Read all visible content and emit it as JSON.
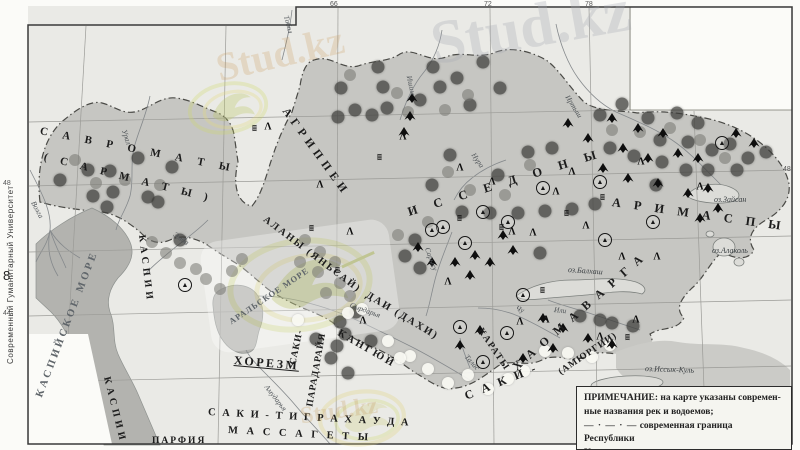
{
  "page": {
    "margin_text": "Современный Гуманитарный Университет",
    "page_number": "8"
  },
  "colors": {
    "paper": "#eaeae6",
    "land": "#c6c6c2",
    "land-se": "#cbcbc7",
    "sea": "#b3b3af",
    "lake": "#dcdcd8",
    "frame": "#3a3a3a",
    "gridline": "#9b9b97",
    "riverline": "#85898c",
    "border-dash": "#4a4a46"
  },
  "legend": {
    "title": "ПРИМЕЧАНИЕ:",
    "line1": "на карте указаны современ-",
    "line2": "ные названия рек и водоемов;",
    "border_symbol": "— · — · —",
    "border_line1": "современная граница Республики",
    "border_line2": "Казахстан"
  },
  "watermark": {
    "ghost_text": "Stud.kz"
  },
  "map": {
    "labels": [
      {
        "t": "С А В Р О М А Т Ы",
        "x": 40,
        "y": 126,
        "r": 11,
        "fs": 11,
        "ls": 6,
        "c": "tribe"
      },
      {
        "t": "( С А Р М А Т Ы )",
        "x": 44,
        "y": 152,
        "r": 14,
        "fs": 11,
        "ls": 5,
        "c": "tribe"
      },
      {
        "t": "АГРИППЕИ",
        "x": 284,
        "y": 104,
        "r": 54,
        "fs": 11.5,
        "ls": 5,
        "c": "tribe"
      },
      {
        "t": "И С С Е Д О Н Ы",
        "x": 408,
        "y": 206,
        "r": -17,
        "fs": 12.5,
        "ls": 7,
        "c": "tribe"
      },
      {
        "t": "А Р И М А С П Ы",
        "x": 612,
        "y": 196,
        "r": 8,
        "fs": 12.5,
        "ls": 5,
        "c": "tribe"
      },
      {
        "t": "АЛАНЫ (ЯНЬСАЙ)",
        "x": 264,
        "y": 214,
        "r": 37,
        "fs": 10,
        "ls": 2,
        "c": "tribe"
      },
      {
        "t": "КАСПИИ",
        "x": 141,
        "y": 230,
        "r": 83,
        "fs": 10,
        "ls": 4,
        "c": "tribe"
      },
      {
        "t": "КАСПИИ",
        "x": 106,
        "y": 372,
        "r": 76,
        "fs": 10,
        "ls": 4,
        "c": "tribe"
      },
      {
        "t": "ДАИ (ДАХИ)",
        "x": 366,
        "y": 290,
        "r": 31,
        "fs": 10.5,
        "ls": 2,
        "c": "tribe"
      },
      {
        "t": "КАНГЮЙ",
        "x": 338,
        "y": 328,
        "r": 30,
        "fs": 10.5,
        "ls": 2.5,
        "c": "tribe"
      },
      {
        "t": "САКИ-",
        "x": 294,
        "y": 360,
        "r": -78,
        "fs": 9.5,
        "ls": 1,
        "c": "tribe"
      },
      {
        "t": "ПАРАДАРАЙЯ",
        "x": 311,
        "y": 402,
        "r": -80,
        "fs": 9.5,
        "ls": 1,
        "c": "tribe"
      },
      {
        "t": "ХОРЕЗМ",
        "x": 234,
        "y": 354,
        "r": 5,
        "fs": 12,
        "ls": 2.5,
        "c": "tribe u"
      },
      {
        "t": "С А К И -",
        "x": 465,
        "y": 390,
        "r": -22,
        "fs": 12,
        "ls": 3,
        "c": "tribe"
      },
      {
        "t": "Х А О М А В А Р Г А",
        "x": 514,
        "y": 362,
        "r": -41,
        "fs": 12,
        "ls": 3,
        "c": "tribe"
      },
      {
        "t": "(АМЮРГИИ)",
        "x": 560,
        "y": 369,
        "r": -34,
        "fs": 9.5,
        "ls": 1,
        "c": "tribe"
      },
      {
        "t": "КАРАТЫ",
        "x": 479,
        "y": 325,
        "r": 56,
        "fs": 9.5,
        "ls": 1.5,
        "c": "tribe"
      },
      {
        "t": "С А К И - Т И Г Р А Х А У Д А",
        "x": 208,
        "y": 408,
        "r": 3,
        "fs": 10.5,
        "ls": 2,
        "c": "tribe"
      },
      {
        "t": "М А С С А Г Е Т Ы",
        "x": 228,
        "y": 426,
        "r": 3,
        "fs": 10.5,
        "ls": 3,
        "c": "tribe"
      },
      {
        "t": "ПАРФИЯ",
        "x": 152,
        "y": 437,
        "r": 0,
        "fs": 9.5,
        "ls": 2,
        "c": "tribe"
      },
      {
        "t": "КАСПИЙСКОЕ МОРЕ",
        "x": 40,
        "y": 392,
        "r": -69,
        "fs": 10.5,
        "ls": 3,
        "c": "sea"
      },
      {
        "t": "АРАЛЬСКОЕ МОРЕ",
        "x": 230,
        "y": 318,
        "r": -34,
        "fs": 8.5,
        "ls": 1,
        "c": "sea"
      },
      {
        "t": "Волга",
        "x": 33,
        "y": 198,
        "r": 62,
        "fs": 7.5,
        "ls": 0,
        "c": "river"
      },
      {
        "t": "Урал",
        "x": 124,
        "y": 126,
        "r": 72,
        "fs": 7.5,
        "ls": 0,
        "c": "river"
      },
      {
        "t": "Эмба",
        "x": 174,
        "y": 230,
        "r": 35,
        "fs": 7.5,
        "ls": 0,
        "c": "river"
      },
      {
        "t": "Тобол",
        "x": 286,
        "y": 12,
        "r": 75,
        "fs": 7.5,
        "ls": 0,
        "c": "river"
      },
      {
        "t": "Ишим",
        "x": 409,
        "y": 72,
        "r": 78,
        "fs": 7.5,
        "ls": 0,
        "c": "river"
      },
      {
        "t": "Иртыш",
        "x": 567,
        "y": 92,
        "r": 58,
        "fs": 7.5,
        "ls": 0,
        "c": "river"
      },
      {
        "t": "Нура",
        "x": 473,
        "y": 150,
        "r": 55,
        "fs": 7.5,
        "ls": 0,
        "c": "river"
      },
      {
        "t": "Сарысу",
        "x": 427,
        "y": 244,
        "r": 70,
        "fs": 7.5,
        "ls": 0,
        "c": "river"
      },
      {
        "t": "Сырдарья",
        "x": 350,
        "y": 301,
        "r": 20,
        "fs": 7.5,
        "ls": 0,
        "c": "river"
      },
      {
        "t": "Амударья",
        "x": 266,
        "y": 382,
        "r": 52,
        "fs": 7.5,
        "ls": 0,
        "c": "river"
      },
      {
        "t": "Чу",
        "x": 516,
        "y": 304,
        "r": 22,
        "fs": 7.5,
        "ls": 0,
        "c": "river"
      },
      {
        "t": "Или",
        "x": 554,
        "y": 306,
        "r": 6,
        "fs": 7.5,
        "ls": 0,
        "c": "river"
      },
      {
        "t": "Талас",
        "x": 466,
        "y": 352,
        "r": 48,
        "fs": 7.5,
        "ls": 0,
        "c": "river"
      },
      {
        "t": "оз.Балхаш",
        "x": 568,
        "y": 266,
        "r": 4,
        "fs": 8,
        "ls": 0,
        "c": "lake"
      },
      {
        "t": "оз.Зайсан",
        "x": 714,
        "y": 196,
        "r": 0,
        "fs": 8,
        "ls": 0,
        "c": "lake"
      },
      {
        "t": "оз.Алаколь",
        "x": 712,
        "y": 247,
        "r": 0,
        "fs": 8,
        "ls": 0,
        "c": "lake"
      },
      {
        "t": "оз.Иссык-Куль",
        "x": 645,
        "y": 365,
        "r": 2,
        "fs": 8,
        "ls": 0,
        "c": "lake"
      },
      {
        "t": "66",
        "x": 330,
        "y": 1,
        "r": 0,
        "fs": 7,
        "ls": 0,
        "c": "grid"
      },
      {
        "t": "72",
        "x": 484,
        "y": 1,
        "r": 0,
        "fs": 7,
        "ls": 0,
        "c": "grid"
      },
      {
        "t": "78",
        "x": 585,
        "y": 1,
        "r": 0,
        "fs": 7,
        "ls": 0,
        "c": "grid"
      },
      {
        "t": "48",
        "x": 3,
        "y": 180,
        "r": 0,
        "fs": 7,
        "ls": 0,
        "c": "grid"
      },
      {
        "t": "44",
        "x": 3,
        "y": 310,
        "r": 0,
        "fs": 7,
        "ls": 0,
        "c": "grid"
      },
      {
        "t": "48",
        "x": 783,
        "y": 166,
        "r": 0,
        "fs": 7,
        "ls": 0,
        "c": "grid"
      }
    ],
    "symbols": {
      "dark": [
        [
          60,
          180
        ],
        [
          88,
          170
        ],
        [
          110,
          171
        ],
        [
          113,
          192
        ],
        [
          138,
          158
        ],
        [
          172,
          167
        ],
        [
          93,
          196
        ],
        [
          107,
          207
        ],
        [
          148,
          197
        ],
        [
          158,
          202
        ],
        [
          180,
          240
        ],
        [
          341,
          88
        ],
        [
          378,
          67
        ],
        [
          383,
          87
        ],
        [
          433,
          67
        ],
        [
          440,
          87
        ],
        [
          355,
          110
        ],
        [
          338,
          117
        ],
        [
          372,
          115
        ],
        [
          387,
          108
        ],
        [
          420,
          100
        ],
        [
          457,
          78
        ],
        [
          483,
          62
        ],
        [
          500,
          88
        ],
        [
          470,
          105
        ],
        [
          600,
          115
        ],
        [
          622,
          104
        ],
        [
          648,
          118
        ],
        [
          677,
          113
        ],
        [
          698,
          123
        ],
        [
          660,
          140
        ],
        [
          688,
          142
        ],
        [
          712,
          150
        ],
        [
          730,
          144
        ],
        [
          748,
          158
        ],
        [
          662,
          162
        ],
        [
          634,
          156
        ],
        [
          610,
          148
        ],
        [
          686,
          170
        ],
        [
          708,
          170
        ],
        [
          656,
          185
        ],
        [
          766,
          152
        ],
        [
          737,
          170
        ],
        [
          498,
          175
        ],
        [
          528,
          152
        ],
        [
          552,
          148
        ],
        [
          450,
          155
        ],
        [
          432,
          185
        ],
        [
          462,
          212
        ],
        [
          490,
          213
        ],
        [
          518,
          213
        ],
        [
          545,
          211
        ],
        [
          572,
          209
        ],
        [
          595,
          204
        ],
        [
          415,
          240
        ],
        [
          405,
          256
        ],
        [
          420,
          268
        ],
        [
          340,
          322
        ],
        [
          345,
          334
        ],
        [
          337,
          346
        ],
        [
          316,
          339
        ],
        [
          331,
          358
        ],
        [
          356,
          312
        ],
        [
          371,
          341
        ],
        [
          348,
          373
        ],
        [
          540,
          253
        ],
        [
          612,
          323
        ],
        [
          633,
          326
        ],
        [
          580,
          316
        ],
        [
          600,
          320
        ]
      ],
      "mid": [
        [
          75,
          160
        ],
        [
          125,
          180
        ],
        [
          160,
          185
        ],
        [
          96,
          183
        ],
        [
          350,
          75
        ],
        [
          397,
          93
        ],
        [
          408,
          112
        ],
        [
          445,
          110
        ],
        [
          468,
          95
        ],
        [
          612,
          130
        ],
        [
          640,
          132
        ],
        [
          670,
          128
        ],
        [
          700,
          140
        ],
        [
          725,
          158
        ],
        [
          530,
          165
        ],
        [
          505,
          195
        ],
        [
          470,
          190
        ],
        [
          448,
          172
        ],
        [
          305,
          240
        ],
        [
          320,
          252
        ],
        [
          335,
          262
        ],
        [
          318,
          272
        ],
        [
          300,
          262
        ],
        [
          340,
          283
        ],
        [
          326,
          293
        ],
        [
          350,
          296
        ],
        [
          152,
          242
        ],
        [
          166,
          253
        ],
        [
          180,
          263
        ],
        [
          196,
          269
        ],
        [
          206,
          279
        ],
        [
          220,
          289
        ],
        [
          232,
          271
        ],
        [
          242,
          259
        ],
        [
          428,
          222
        ],
        [
          398,
          235
        ]
      ],
      "light": [
        [
          348,
          313
        ],
        [
          362,
          309
        ],
        [
          410,
          356
        ],
        [
          428,
          369
        ],
        [
          448,
          383
        ],
        [
          468,
          375
        ],
        [
          488,
          389
        ],
        [
          508,
          379
        ],
        [
          524,
          371
        ],
        [
          545,
          351
        ],
        [
          568,
          353
        ],
        [
          592,
          357
        ],
        [
          610,
          345
        ],
        [
          388,
          341
        ],
        [
          400,
          358
        ],
        [
          298,
          320
        ]
      ],
      "peak": [
        [
          612,
          118
        ],
        [
          638,
          128
        ],
        [
          663,
          133
        ],
        [
          623,
          148
        ],
        [
          648,
          158
        ],
        [
          678,
          153
        ],
        [
          698,
          158
        ],
        [
          603,
          168
        ],
        [
          628,
          178
        ],
        [
          658,
          183
        ],
        [
          688,
          193
        ],
        [
          708,
          188
        ],
        [
          568,
          123
        ],
        [
          588,
          138
        ],
        [
          736,
          133
        ],
        [
          754,
          143
        ],
        [
          412,
          98
        ],
        [
          410,
          116
        ],
        [
          404,
          132
        ],
        [
          503,
          235
        ],
        [
          513,
          250
        ],
        [
          490,
          262
        ],
        [
          475,
          255
        ],
        [
          455,
          262
        ],
        [
          470,
          275
        ],
        [
          418,
          247
        ],
        [
          432,
          262
        ],
        [
          543,
          318
        ],
        [
          563,
          328
        ],
        [
          588,
          338
        ],
        [
          612,
          344
        ],
        [
          553,
          348
        ],
        [
          523,
          358
        ],
        [
          480,
          330
        ],
        [
          460,
          345
        ],
        [
          718,
          208
        ],
        [
          700,
          218
        ]
      ],
      "ct": [
        [
          185,
          285
        ],
        [
          443,
          227
        ],
        [
          465,
          243
        ],
        [
          460,
          327
        ],
        [
          483,
          362
        ],
        [
          507,
          333
        ],
        [
          523,
          295
        ],
        [
          543,
          188
        ],
        [
          432,
          230
        ],
        [
          508,
          222
        ],
        [
          600,
          182
        ],
        [
          653,
          222
        ],
        [
          605,
          240
        ],
        [
          722,
          143
        ],
        [
          483,
          212
        ]
      ],
      "lam": [
        [
          320,
          185
        ],
        [
          403,
          137
        ],
        [
          350,
          232
        ],
        [
          363,
          321
        ],
        [
          460,
          168
        ],
        [
          492,
          182
        ],
        [
          512,
          232
        ],
        [
          533,
          233
        ],
        [
          556,
          192
        ],
        [
          572,
          172
        ],
        [
          586,
          226
        ],
        [
          622,
          257
        ],
        [
          641,
          162
        ],
        [
          657,
          257
        ],
        [
          700,
          187
        ],
        [
          520,
          322
        ],
        [
          546,
          320
        ],
        [
          600,
          337
        ],
        [
          636,
          320
        ],
        [
          268,
          127
        ],
        [
          448,
          282
        ]
      ],
      "sh": [
        [
          255,
          128
        ],
        [
          380,
          157
        ],
        [
          502,
          227
        ],
        [
          567,
          213
        ],
        [
          603,
          197
        ],
        [
          460,
          218
        ],
        [
          312,
          228
        ],
        [
          628,
          337
        ],
        [
          338,
          270
        ],
        [
          543,
          290
        ]
      ]
    }
  }
}
